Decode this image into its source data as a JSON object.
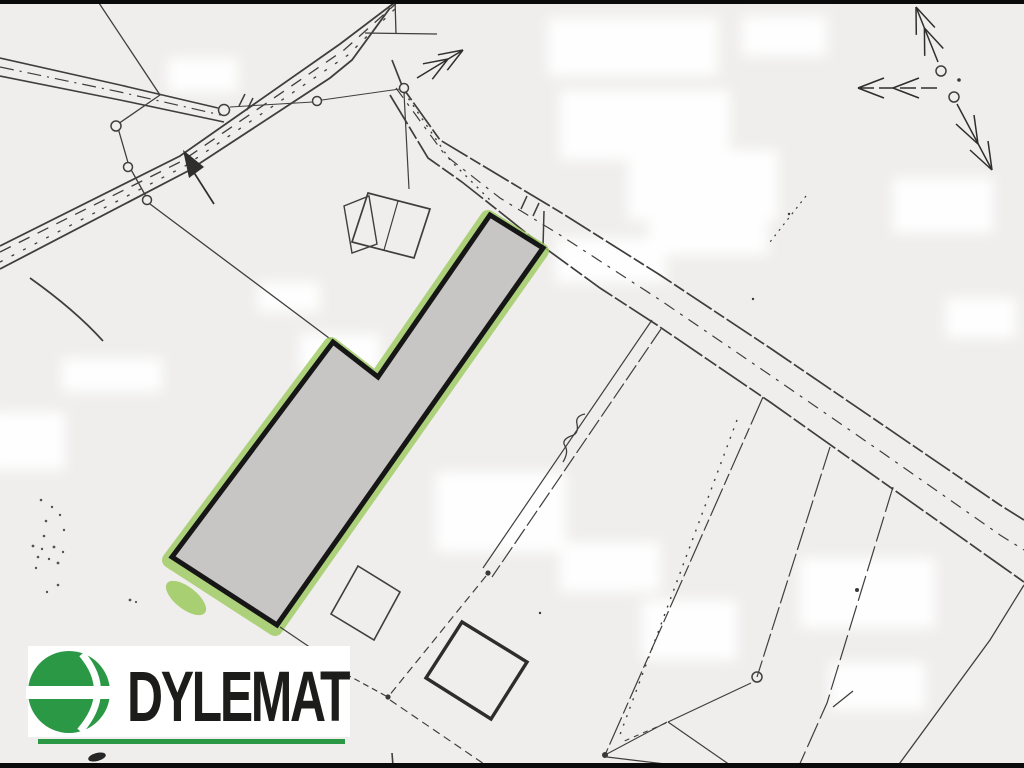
{
  "logo": {
    "text": "DYLEMAT",
    "brand_green": "#2b9846",
    "text_color": "#1c1c1a"
  },
  "map": {
    "paper_color": "#efeeec",
    "ink_color": "#3f3e3c",
    "highlighted_parcel": {
      "fill": "#c7c6c4",
      "outline": "#161616",
      "halo_green": "#9cc95e",
      "shape": "L-shaped elongated parcel oriented NE-SW"
    }
  }
}
